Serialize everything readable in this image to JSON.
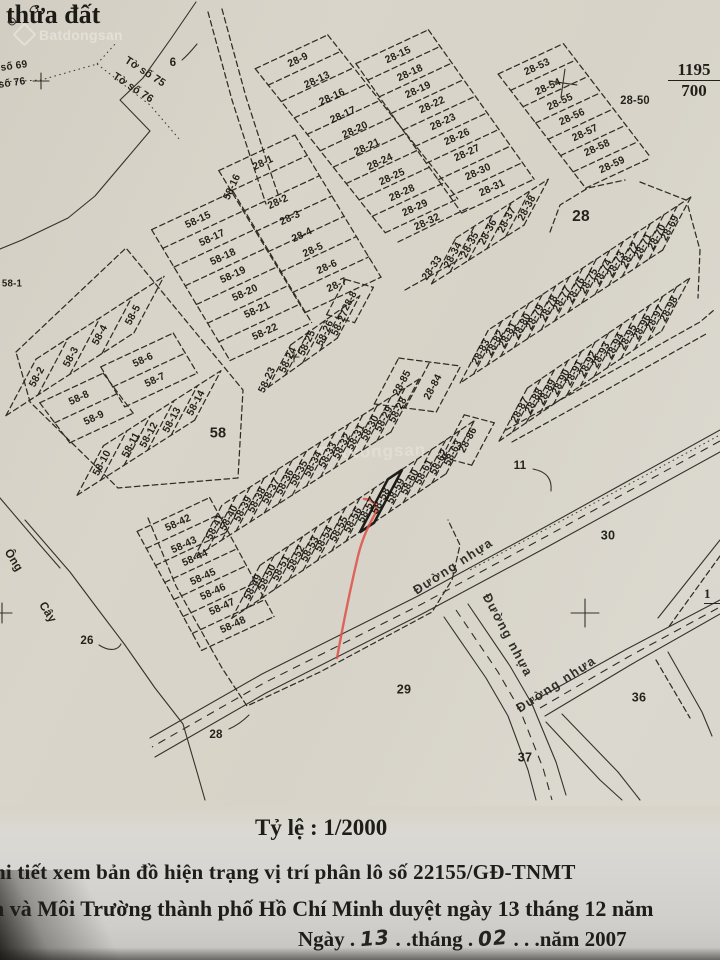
{
  "page": {
    "title_partial": "thửa đất"
  },
  "watermarks": {
    "logo_text": "Batdongsan",
    "center_text": "Batdongsan"
  },
  "corner_refs": {
    "sheet_fraction_top": "1195",
    "sheet_fraction_bottom": "700",
    "edge_fraction_partial": "1"
  },
  "footer": {
    "scale": "Tỷ lệ : 1/2000",
    "line1": "hi tiết xem bản đồ hiện trạng vị trí phân lô số 22155/GĐ-TNMT",
    "line2": "n và Môi Trường thành phố Hồ Chí Minh duyệt ngày 13 tháng 12 năm",
    "line3_prefix": "Ngày .",
    "line3_day": "13",
    "line3_mid": ". .tháng .",
    "line3_month": "02",
    "line3_suffix": ". . .năm 2007"
  },
  "map": {
    "highlighted_plot": "58-58",
    "labels": [
      [
        "28-9",
        298,
        60,
        -25
      ],
      [
        "28-13",
        317,
        80,
        -25
      ],
      [
        "28-16",
        332,
        97,
        -25
      ],
      [
        "28-17",
        343,
        115,
        -25
      ],
      [
        "28-20",
        355,
        130,
        -25
      ],
      [
        "28-21",
        367,
        147,
        -25
      ],
      [
        "28-24",
        380,
        162,
        -25
      ],
      [
        "28-25",
        392,
        177,
        -25
      ],
      [
        "28-28",
        402,
        193,
        -25
      ],
      [
        "28-29",
        415,
        208,
        -25
      ],
      [
        "28-15",
        398,
        55,
        -25
      ],
      [
        "28-18",
        410,
        73,
        -25
      ],
      [
        "28-19",
        418,
        90,
        -25
      ],
      [
        "28-22",
        432,
        105,
        -25
      ],
      [
        "28-23",
        443,
        122,
        -25
      ],
      [
        "28-26",
        457,
        137,
        -25
      ],
      [
        "28-27",
        467,
        153,
        -25
      ],
      [
        "28-30",
        478,
        172,
        -25
      ],
      [
        "28-31",
        492,
        188,
        -25
      ],
      [
        "28-32",
        427,
        222,
        -25
      ],
      [
        "28-33",
        432,
        268,
        -55
      ],
      [
        "28-34",
        453,
        255,
        -62
      ],
      [
        "28-35",
        470,
        245,
        -62
      ],
      [
        "28-36",
        488,
        232,
        -62
      ],
      [
        "28-37",
        507,
        220,
        -62
      ],
      [
        "28-38",
        527,
        208,
        -62
      ],
      [
        "28-53",
        537,
        67,
        -25
      ],
      [
        "28-54",
        548,
        87,
        -25
      ],
      [
        "28-55",
        560,
        102,
        -25
      ],
      [
        "28-56",
        572,
        117,
        -25
      ],
      [
        "28-57",
        585,
        133,
        -25
      ],
      [
        "28-58",
        597,
        148,
        -25
      ],
      [
        "28-59",
        612,
        165,
        -25
      ],
      [
        "28-50",
        635,
        101,
        0,
        11.5
      ],
      [
        "28-1",
        263,
        163,
        -25
      ],
      [
        "28-2",
        278,
        202,
        -25
      ],
      [
        "28-3",
        290,
        218,
        -25
      ],
      [
        "28-4",
        302,
        235,
        -25
      ],
      [
        "28-5",
        313,
        250,
        -25
      ],
      [
        "28-6",
        327,
        267,
        -25
      ],
      [
        "28-7",
        337,
        285,
        -25
      ],
      [
        "28-8",
        350,
        301,
        -62,
        10
      ],
      [
        "58-16",
        232,
        187,
        -65
      ],
      [
        "58-15",
        198,
        220,
        -25
      ],
      [
        "58-17",
        212,
        238,
        -25
      ],
      [
        "58-18",
        223,
        257,
        -25
      ],
      [
        "58-19",
        233,
        275,
        -25
      ],
      [
        "58-20",
        245,
        293,
        -25
      ],
      [
        "58-21",
        257,
        310,
        -25
      ],
      [
        "58-22",
        265,
        332,
        -25
      ],
      [
        "58-23",
        267,
        380,
        -65
      ],
      [
        "58-24",
        288,
        360,
        -65
      ],
      [
        "58-25",
        307,
        343,
        -65
      ],
      [
        "58-26",
        325,
        333,
        -65
      ],
      [
        "58-27",
        340,
        323,
        -65
      ],
      [
        "58-1",
        12,
        284,
        0,
        10
      ],
      [
        "58-2",
        37,
        377,
        -62
      ],
      [
        "58-3",
        71,
        357,
        -62
      ],
      [
        "58-4",
        100,
        335,
        -62
      ],
      [
        "58-5",
        133,
        315,
        -62
      ],
      [
        "58-6",
        143,
        360,
        -25
      ],
      [
        "58-7",
        155,
        380,
        -25
      ],
      [
        "58-8",
        79,
        398,
        -25
      ],
      [
        "58-9",
        94,
        418,
        -25
      ],
      [
        "58-10",
        102,
        463,
        -62
      ],
      [
        "58-11",
        131,
        445,
        -62
      ],
      [
        "58-12",
        149,
        435,
        -62
      ],
      [
        "58-13",
        172,
        420,
        -62
      ],
      [
        "58-14",
        196,
        403,
        -62
      ],
      [
        "58",
        218,
        433,
        0,
        15
      ],
      [
        "58-28",
        398,
        410,
        -62
      ],
      [
        "58-29",
        384,
        419,
        -62
      ],
      [
        "58-30",
        370,
        428,
        -62
      ],
      [
        "58-31",
        356,
        437,
        -62
      ],
      [
        "58-32",
        342,
        446,
        -62
      ],
      [
        "58-33",
        328,
        455,
        -62
      ],
      [
        "58-34",
        313,
        464,
        -62
      ],
      [
        "58-35",
        299,
        473,
        -62
      ],
      [
        "58-36",
        285,
        482,
        -62
      ],
      [
        "58-37",
        271,
        491,
        -62
      ],
      [
        "58-38",
        257,
        500,
        -62
      ],
      [
        "58-39",
        243,
        509,
        -62
      ],
      [
        "58-40",
        229,
        518,
        -62
      ],
      [
        "58-41",
        215,
        527,
        -62
      ],
      [
        "58-49",
        253,
        587,
        -62
      ],
      [
        "58-50",
        267,
        577,
        -62
      ],
      [
        "58-51",
        281,
        568,
        -62
      ],
      [
        "58-52",
        296,
        558,
        -62
      ],
      [
        "58-53",
        310,
        549,
        -62
      ],
      [
        "58-54",
        324,
        539,
        -62
      ],
      [
        "58-55",
        339,
        529,
        -62
      ],
      [
        "58-56",
        353,
        520,
        -62
      ],
      [
        "58-57",
        367,
        510,
        -62
      ],
      [
        "58-58",
        381,
        501,
        -62,
        11
      ],
      [
        "58-59",
        396,
        491,
        -62
      ],
      [
        "58-60",
        410,
        482,
        -62
      ],
      [
        "58-61",
        424,
        472,
        -62
      ],
      [
        "58-62",
        439,
        462,
        -62
      ],
      [
        "58-63",
        453,
        453,
        -62
      ],
      [
        "58-42",
        178,
        523,
        -25
      ],
      [
        "58-43",
        184,
        545,
        -25
      ],
      [
        "58-44",
        195,
        558,
        -25
      ],
      [
        "58-45",
        203,
        577,
        -25
      ],
      [
        "58-46",
        213,
        592,
        -25
      ],
      [
        "58-47",
        222,
        607,
        -25
      ],
      [
        "58-48",
        233,
        625,
        -25
      ],
      [
        "28-85",
        402,
        383,
        -62
      ],
      [
        "28-84",
        433,
        387,
        -62
      ],
      [
        "28-86",
        468,
        440,
        -62
      ],
      [
        "28-69",
        670,
        228,
        -62
      ],
      [
        "28-70",
        657,
        237,
        -62
      ],
      [
        "28-71",
        643,
        246,
        -62
      ],
      [
        "28-72",
        630,
        255,
        -62
      ],
      [
        "28-73",
        616,
        264,
        -62
      ],
      [
        "28-74",
        603,
        272,
        -62
      ],
      [
        "28-75",
        589,
        281,
        -62
      ],
      [
        "28-76",
        576,
        290,
        -62
      ],
      [
        "28-77",
        562,
        299,
        -62
      ],
      [
        "28-78",
        549,
        308,
        -62
      ],
      [
        "28-79",
        535,
        317,
        -62
      ],
      [
        "28-80",
        522,
        326,
        -62
      ],
      [
        "28-81",
        508,
        335,
        -62
      ],
      [
        "28-82",
        495,
        343,
        -62
      ],
      [
        "28-83",
        481,
        352,
        -62
      ],
      [
        "28-87",
        520,
        410,
        -62
      ],
      [
        "28-88",
        534,
        401,
        -62
      ],
      [
        "28-89",
        547,
        392,
        -62
      ],
      [
        "28-90",
        561,
        382,
        -62
      ],
      [
        "28-91",
        574,
        373,
        -62
      ],
      [
        "28-92",
        588,
        364,
        -62
      ],
      [
        "28-93",
        601,
        355,
        -62
      ],
      [
        "28-94",
        615,
        346,
        -62
      ],
      [
        "28-95",
        628,
        337,
        -62
      ],
      [
        "28-96",
        642,
        327,
        -62
      ],
      [
        "28-97",
        655,
        318,
        -62
      ],
      [
        "28-98",
        669,
        309,
        -62
      ],
      [
        "28",
        581,
        217,
        0,
        16
      ],
      [
        "6",
        173,
        62,
        0,
        12
      ],
      [
        "11",
        520,
        465,
        0,
        12
      ],
      [
        "26",
        87,
        640,
        0,
        12
      ],
      [
        "28",
        216,
        734,
        0,
        12
      ],
      [
        "29",
        404,
        689,
        0,
        13
      ],
      [
        "30",
        608,
        535,
        0,
        13
      ],
      [
        "36",
        639,
        697,
        0,
        13
      ],
      [
        "37",
        525,
        757,
        0,
        13
      ],
      [
        "Tờ số 75",
        145,
        72,
        33,
        11
      ],
      [
        "Tờ số 76",
        133,
        88,
        33,
        11
      ],
      [
        "số 69",
        14,
        66,
        -8,
        10.5
      ],
      [
        "số 76",
        12,
        83,
        -8,
        10.5
      ],
      [
        "Ông",
        14,
        560,
        58,
        12
      ],
      [
        "Cây",
        48,
        612,
        58,
        12
      ],
      [
        "Đường nhựa",
        453,
        566,
        -33,
        13
      ],
      [
        "Đường nhựa",
        508,
        635,
        62,
        13
      ],
      [
        "Đường nhựa",
        556,
        684,
        -33,
        13
      ]
    ]
  }
}
